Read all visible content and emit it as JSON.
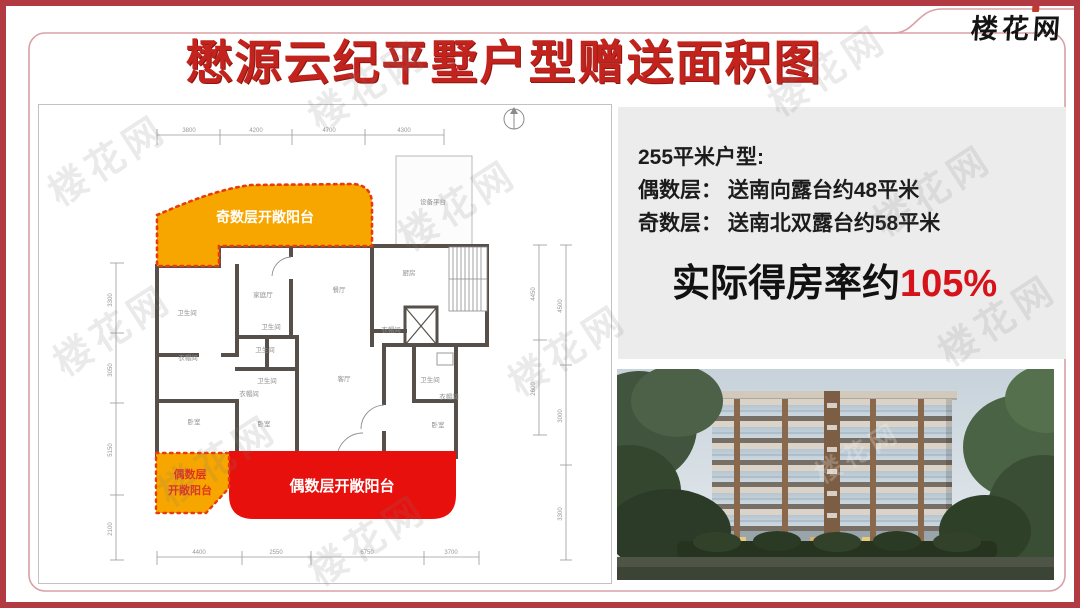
{
  "page": {
    "title": "懋源云纪平墅户型赠送面积图"
  },
  "logo": {
    "text": "楼花网"
  },
  "watermark": {
    "text": "楼花网"
  },
  "info_panel": {
    "line1": "255平米户型:",
    "line2": "偶数层： 送南向露台约48平米",
    "line3": "奇数层： 送南北双露台约58平米",
    "highlight_prefix": "实际得房率约",
    "highlight_value": "105%"
  },
  "floor_plan": {
    "odd_balcony_label": "奇数层开敞阳台",
    "even_balcony_label": "偶数层开敞阳台",
    "even_balcony_small_line1": "偶数层",
    "even_balcony_small_line2": "开敞阳台",
    "rooms": [
      "设备平台",
      "厨房",
      "卫生间",
      "家庭厅",
      "餐厅",
      "衣帽间",
      "卫生间",
      "客厅",
      "衣帽间",
      "卫生间",
      "卫生间",
      "衣帽间",
      "卧室",
      "卧室",
      "卫生间",
      "衣帽间",
      "卧室"
    ],
    "dims_top": [
      "3800",
      "4200",
      "4700",
      "4300"
    ],
    "dims_left": [
      "3300",
      "3050",
      "5150",
      "2100"
    ],
    "dims_right_inner": [
      "4450",
      "2600"
    ],
    "dims_right_outer": [
      "4500",
      "3000",
      "3300"
    ],
    "dims_bottom": [
      "4400",
      "2550",
      "6750",
      "3700"
    ]
  },
  "colors": {
    "accent_red": "#c3231d",
    "balcony_orange": "#f7a600",
    "balcony_red": "#e8100c",
    "dotted_border_red": "#e83b0c",
    "panel_bg": "#edecec",
    "highlight_red": "#d6121b",
    "outer_border": "#b23a42",
    "inner_border": "#d9a0a6"
  }
}
